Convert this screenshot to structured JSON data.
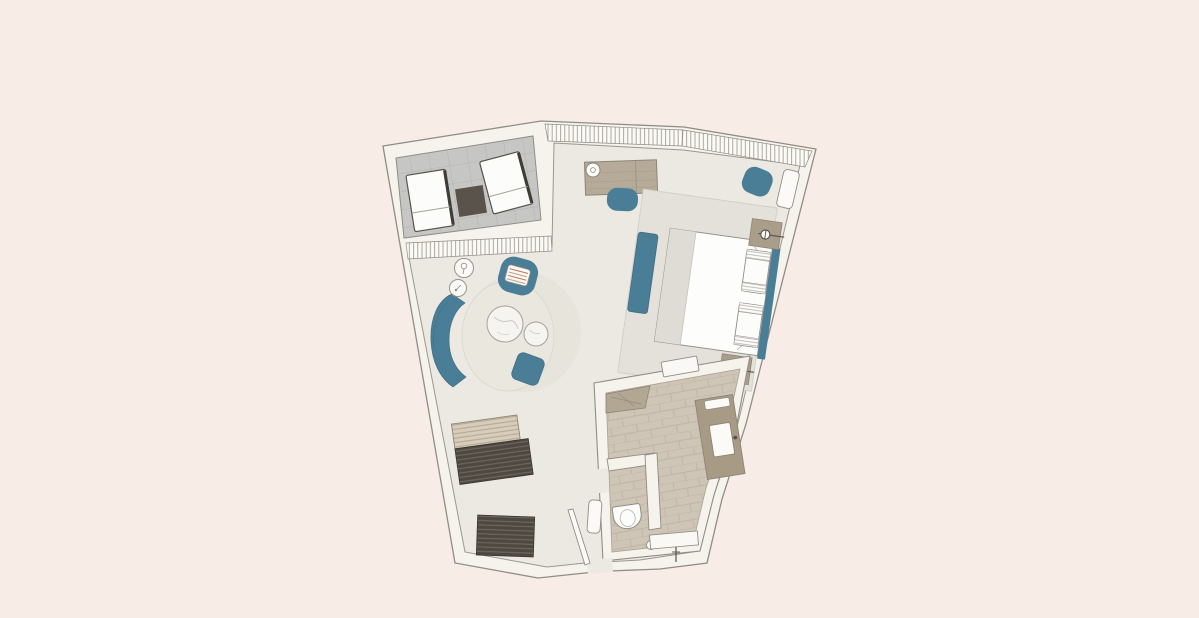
{
  "plan": {
    "kind": "hotel-room-floor-plan",
    "rooms": [
      {
        "name": "terrace",
        "floor": "tile-grid",
        "furniture": [
          "sun-lounger",
          "sun-lounger",
          "terrace-side-table"
        ]
      },
      {
        "name": "living-sleeping-area",
        "floor": "plain",
        "furniture": [
          "desk",
          "desk-lamp",
          "desk-chair",
          "round-pouf",
          "wall-bench",
          "double-bed",
          "bed-rug",
          "bed-bench",
          "headboard",
          "nightstand",
          "nightstand",
          "wall-sconce",
          "wall-sconce",
          "sofa",
          "armchair",
          "coffee-table-large",
          "coffee-table-small",
          "floor-pouf",
          "side-table",
          "side-table",
          "luggage-bench",
          "wardrobe-upper",
          "wardrobe-lower"
        ]
      },
      {
        "name": "bathroom",
        "floor": "stone-tile",
        "furniture": [
          "corner-shelf",
          "wall-niche",
          "vanity-counter",
          "sink",
          "vanity-shelf",
          "toilet",
          "floor-drain",
          "shower-bench",
          "shower-control"
        ]
      },
      {
        "name": "entry",
        "furniture": [
          "entry-door",
          "bathroom-door-leaf"
        ]
      }
    ],
    "windows": [
      "terrace-glazing-band",
      "north-glazing-band",
      "northeast-glazing-band"
    ]
  },
  "colors": {
    "background": "#f7ece6",
    "floor": "#ebe9e1",
    "wall_fill": "#f5f3ec",
    "wall_line": "#8f8d85",
    "terrace_tile": "#c6c6c4",
    "terrace_tile_line": "#b3b3b1",
    "accent_teal": "#4a7e96",
    "teal_dark": "#3f6e84",
    "furniture_taupe": "#b6ab99",
    "nightstand_taupe": "#aa9e8a",
    "vanity_taupe": "#a79b86",
    "bathroom_tile": "#cfc5b7",
    "bathroom_tile_line": "#bfb5a7",
    "corner_shelf_taupe": "#b2a793",
    "wardrobe_dark": "#4e4841",
    "wardrobe_stripe": "#736c62",
    "bench_beige": "#d8cdbb",
    "bench_stripe": "#b3a68e",
    "rug_gray": "#e3e1da",
    "seating_rug": "#eae7df",
    "bed_white": "#fdfdfb",
    "bed_runner": "#dedcd5",
    "marble_white": "#f5f4f1",
    "lounge_white": "#fcfcfa",
    "lounge_frame": "#3f3c38",
    "side_table_dark": "#59534c",
    "cushion_stripe_red": "#c5764f"
  }
}
